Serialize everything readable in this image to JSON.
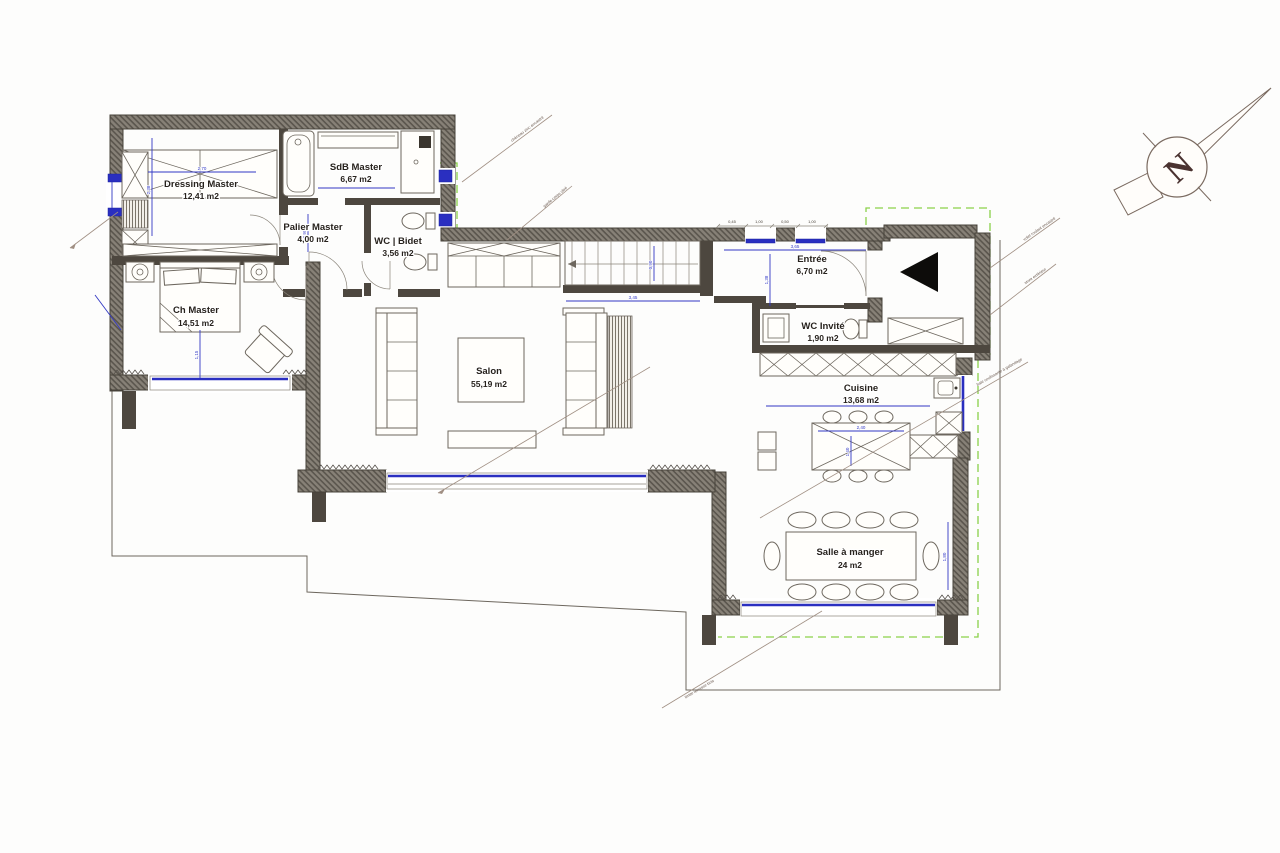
{
  "drawing": {
    "type": "floor-plan",
    "colors": {
      "wall_gray": "#6b655c",
      "dimension_blue": "#3238c4",
      "window_blue": "#2a2fc0",
      "terrace_dashed_green": "#8bd14a"
    }
  },
  "rooms": {
    "dressing": {
      "name": "Dressing Master",
      "area": "12,41 m2"
    },
    "sdb": {
      "name": "SdB Master",
      "area": "6,67 m2"
    },
    "palier": {
      "name": "Palier Master",
      "area": "4,00 m2"
    },
    "wc_bidet": {
      "name": "WC | Bidet",
      "area": "3,56 m2"
    },
    "ch": {
      "name": "Ch Master",
      "area": "14,51 m2"
    },
    "salon": {
      "name": "Salon",
      "area": "55,19 m2"
    },
    "entree": {
      "name": "Entrée",
      "area": "6,70 m2"
    },
    "wc_invite": {
      "name": "WC Invité",
      "area": "1,90 m2"
    },
    "cuisine": {
      "name": "Cuisine",
      "area": "13,68 m2"
    },
    "sam": {
      "name": "Salle à manger",
      "area": "24 m2"
    }
  },
  "compass": {
    "letter": "N"
  },
  "dims": {
    "d_dressing_w": "2,70",
    "d_dressing_h": "2,38",
    "d_ch": "1,15",
    "d_stairs": "3,45",
    "d_stairs_v": "0,90",
    "d_entree": "3,65",
    "d_entree_v": "1,38",
    "d_cuisine": "4,23",
    "d_island_w": "2,40",
    "d_island_d": "1,40",
    "d_dining": "1,80",
    "d_palier": "0,95",
    "tc1": "0,45",
    "tc2": "1,00",
    "tc3": "0,50",
    "tc4": "1,00"
  },
  "annotations": {
    "a1": "chéneau zinc encastré",
    "a2": "garde-corps vitré",
    "a3": "volet roulant encastré",
    "a4": "store extérieur",
    "a5": "baie coulissante à galandage",
    "a6": "limite terrasse bois"
  }
}
